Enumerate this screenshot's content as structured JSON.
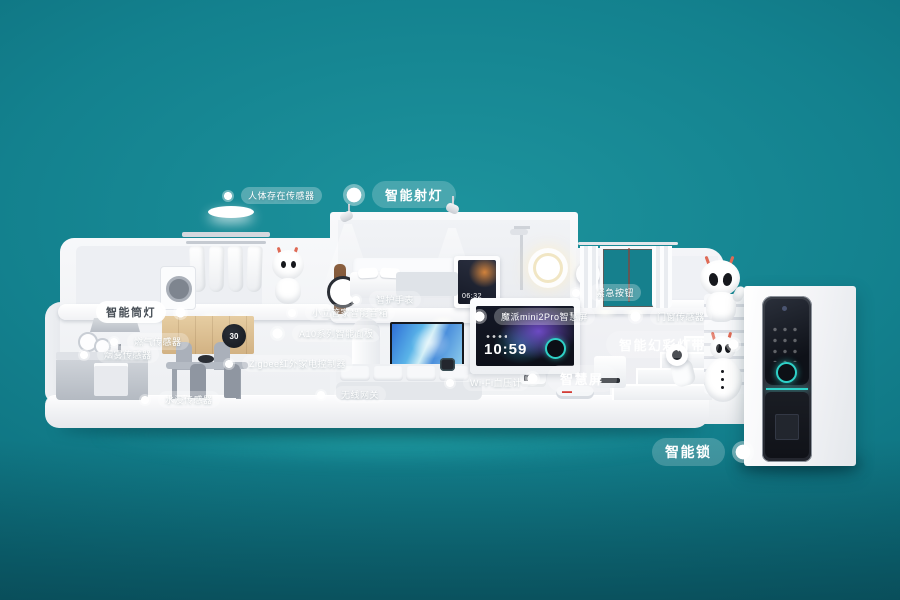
{
  "labels": {
    "human_presence": "人体存在传感器",
    "spotlight": "智能射灯",
    "downlight": "智能筒灯",
    "gas_sensor": "燃气传感器",
    "smoke_sensor": "烟雾传感器",
    "water_leak": "水浸传感器",
    "speaker": "小立管家智能音箱",
    "watch": "智护手表",
    "panel": "A10系列智能面板",
    "ir_controller": "Zigbee红外家电控制器",
    "gateway": "无线网关",
    "bp_monitor": "Wi-Fi血压计",
    "mini_screen": "魔派mini2Pro智慧屏",
    "smart_screen": "智慧屏",
    "emergency_button": "紧急按钮",
    "door_sensor": "门窗传感器",
    "light_strip": "智能幻彩灯带",
    "smart_lock": "智能锁"
  },
  "devices": {
    "thermostat_temp": "30",
    "wall_panel_time": "06:32",
    "smart_screen_time": "10:59"
  },
  "colors": {
    "background_teal": "#13818e",
    "accent_teal": "#2fd1c8",
    "gold_cabinet": "#d8b98c"
  }
}
